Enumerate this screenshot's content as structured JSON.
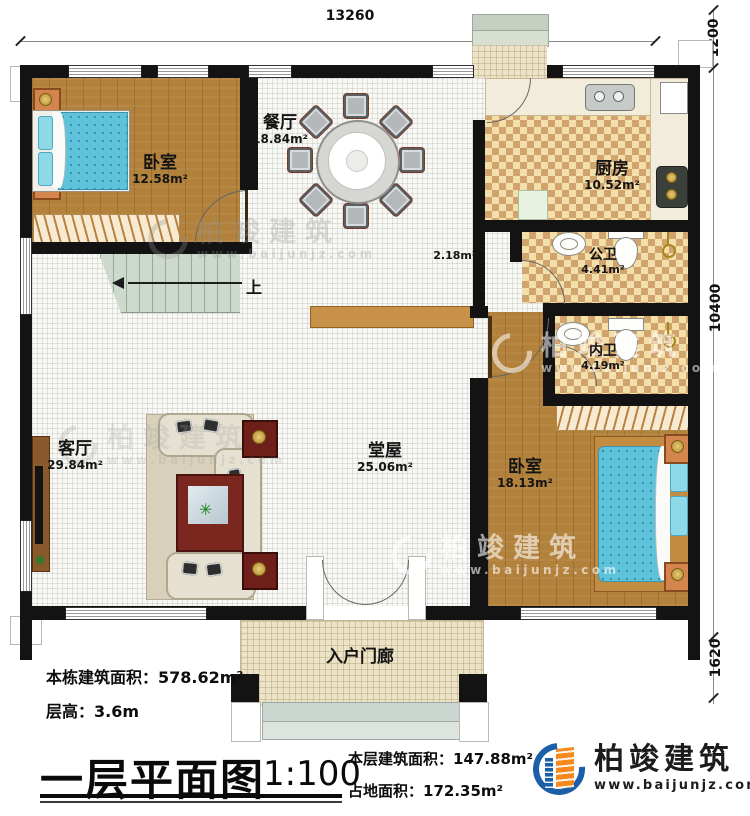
{
  "dimensions": {
    "top": "13260",
    "right_top": "1200",
    "right_mid": "10400",
    "right_bottom": "1620"
  },
  "rooms": [
    {
      "name": "卧室",
      "area": "12.58m²"
    },
    {
      "name": "餐厅",
      "area": "18.84m²"
    },
    {
      "name": "厨房",
      "area": "10.52m²"
    },
    {
      "name": "公卫",
      "area": "4.41m²"
    },
    {
      "name": "内卫",
      "area": "4.19m²"
    },
    {
      "name": "",
      "area": "2.18m²"
    },
    {
      "name": "堂屋",
      "area": "25.06m²"
    },
    {
      "name": "客厅",
      "area": "29.84m²"
    },
    {
      "name": "卧室",
      "area": "18.13m²"
    },
    {
      "name": "入户门廊",
      "area": ""
    }
  ],
  "stairs": {
    "up_label": "上"
  },
  "info": {
    "building_total_label": "本栋建筑面积：",
    "building_total_value": "578.62m²",
    "floor_height_label": "层高：",
    "floor_height_value": "3.6m",
    "title": "一层平面图",
    "scale": "1:100",
    "floor_area_label": "本层建筑面积：",
    "floor_area_value": "147.88m²",
    "footprint_label": "占地面积：",
    "footprint_value": "172.35m²"
  },
  "branding": {
    "company": "柏竣建筑",
    "website": "www.baijunjz.com"
  },
  "watermark": {
    "text": "柏竣建筑",
    "url": "www.baijunjz.com"
  },
  "colors": {
    "wall": "#131313",
    "wood_floor": "#b2813b",
    "checker_light": "#f3dfaa",
    "checker_dark": "#d2a46d",
    "brand_blue": "#1b5fa8",
    "brand_orange": "#f5891d"
  }
}
